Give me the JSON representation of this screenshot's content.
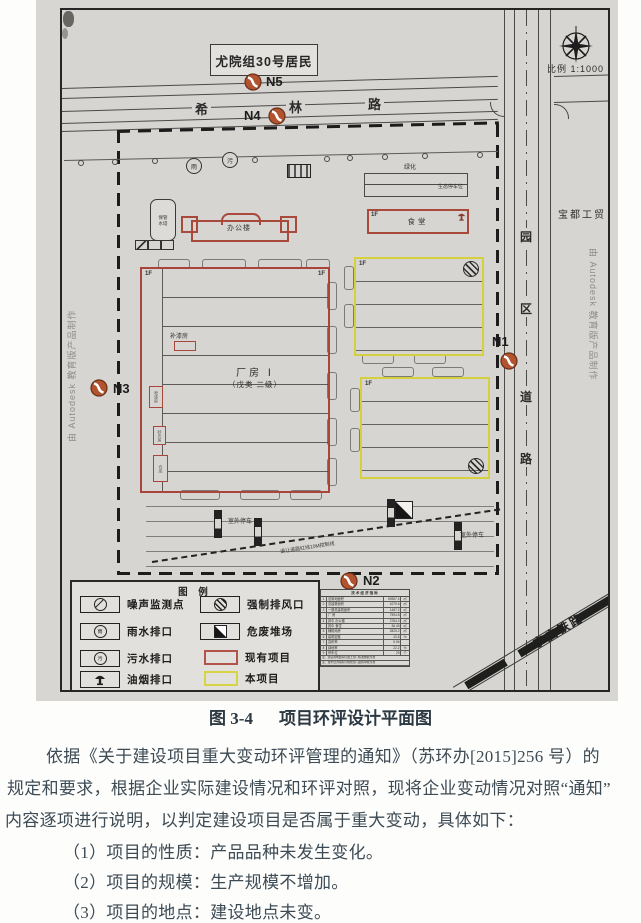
{
  "plan": {
    "scale": "比例 1:1000",
    "resident_box": "尤院组30号居民",
    "north_road": {
      "chars": [
        "希",
        "林",
        "路"
      ]
    },
    "east_road": {
      "chars": [
        "园",
        "区",
        "道",
        "路"
      ]
    },
    "railway_label": "宁启铁路",
    "neighbor_company": "宝都工贸",
    "watermark": "由 Autodesk 教育版产品制作",
    "markers": {
      "n1": "N1",
      "n2": "N2",
      "n3": "N3",
      "n4": "N4",
      "n5": "N5"
    },
    "green_label": "绿化",
    "eco_parking": "生态停车位",
    "outdoor_parking_1": "室外停车",
    "outdoor_parking_2": "室外停车",
    "setback_note": "退让道路红线10M控制线",
    "outlet_rain_char": "雨",
    "outlet_sewage_char": "污",
    "buildings": {
      "office": "办公楼",
      "canteen": "食堂",
      "canteen_floor": "1F",
      "workshop_title": "厂房 Ⅰ",
      "workshop_sub": "（戊类 二级）",
      "workshop_floor_left": "1F",
      "workshop_floor_right": "1F",
      "paint_repair": "补漆房",
      "storage_keeper": "保管",
      "water_tower": "水塔",
      "spray_room": "喷漆房",
      "sanding_room": "砂光房",
      "warehouse": "仓库",
      "y1_floor": "1F",
      "y2_floor": "1F"
    },
    "legend": {
      "title": "图 例",
      "items": [
        {
          "icon": "noise-monitor-icon",
          "label": "噪声监测点"
        },
        {
          "icon": "rain-outlet-icon",
          "label": "雨水排口"
        },
        {
          "icon": "sewage-outlet-icon",
          "label": "污水排口"
        },
        {
          "icon": "oil-fume-outlet-icon",
          "label": "油烟排口"
        },
        {
          "icon": "forced-exhaust-icon",
          "label": "强制排风口"
        },
        {
          "icon": "hazard-waste-icon",
          "label": "危废堆场"
        },
        {
          "icon": "existing-project-swatch",
          "label": "现有项目",
          "color": "#b2544a"
        },
        {
          "icon": "new-project-swatch",
          "label": "本项目",
          "color": "#d8d342"
        }
      ]
    },
    "indicator_table": {
      "title": "技术经济指标",
      "rows": [
        {
          "no": "1",
          "label": "总用地面积",
          "value": "50967.4",
          "unit": "㎡"
        },
        {
          "no": "2",
          "label": "总建筑面积",
          "value": "4279.6",
          "unit": "㎡"
        },
        {
          "no": "3",
          "label": "一期总建筑面积",
          "value": "1487.2",
          "unit": "㎡"
        },
        {
          "no": "",
          "label": "厂 房",
          "value": "7594.8",
          "unit": "㎡"
        },
        {
          "no": "4",
          "label": "其中 办公楼",
          "value": "2784.4",
          "unit": "㎡"
        },
        {
          "no": "",
          "label": "其中 食堂",
          "value": "36.49",
          "unit": "㎡"
        },
        {
          "no": "5",
          "label": "辅助用房",
          "value": "2825.2",
          "unit": "㎡"
        },
        {
          "no": "6",
          "label": "建筑密度",
          "value": "43.8",
          "unit": "%"
        },
        {
          "no": "7",
          "label": "容积率",
          "value": "5.96",
          "unit": ""
        },
        {
          "no": "8",
          "label": "绿地率",
          "value": "22.2",
          "unit": "%"
        },
        {
          "no": "9",
          "label": "停车位",
          "value": "29",
          "unit": "个"
        }
      ],
      "notes": [
        "注：建设用地面积以国土部门核发数据为准",
        "注：技术经济指标以规划部门最终审批为准"
      ]
    }
  },
  "caption": {
    "figure_no": "图 3-4",
    "title": "项目环评设计平面图"
  },
  "body": {
    "lines": [
      "依据《关于建设项目重大变动环评管理的通知》（苏环办[2015]256 号）的",
      "规定和要求，根据企业实际建设情况和环评对照，现将企业变动情况对照“通知”",
      "内容逐项进行说明，以判定建设项目是否属于重大变动，具体如下："
    ],
    "items": [
      "（1）项目的性质：产品品种未发生变化。",
      "（2）项目的规模：生产规模不增加。",
      "（3）项目的地点：建设地点未变。"
    ]
  }
}
